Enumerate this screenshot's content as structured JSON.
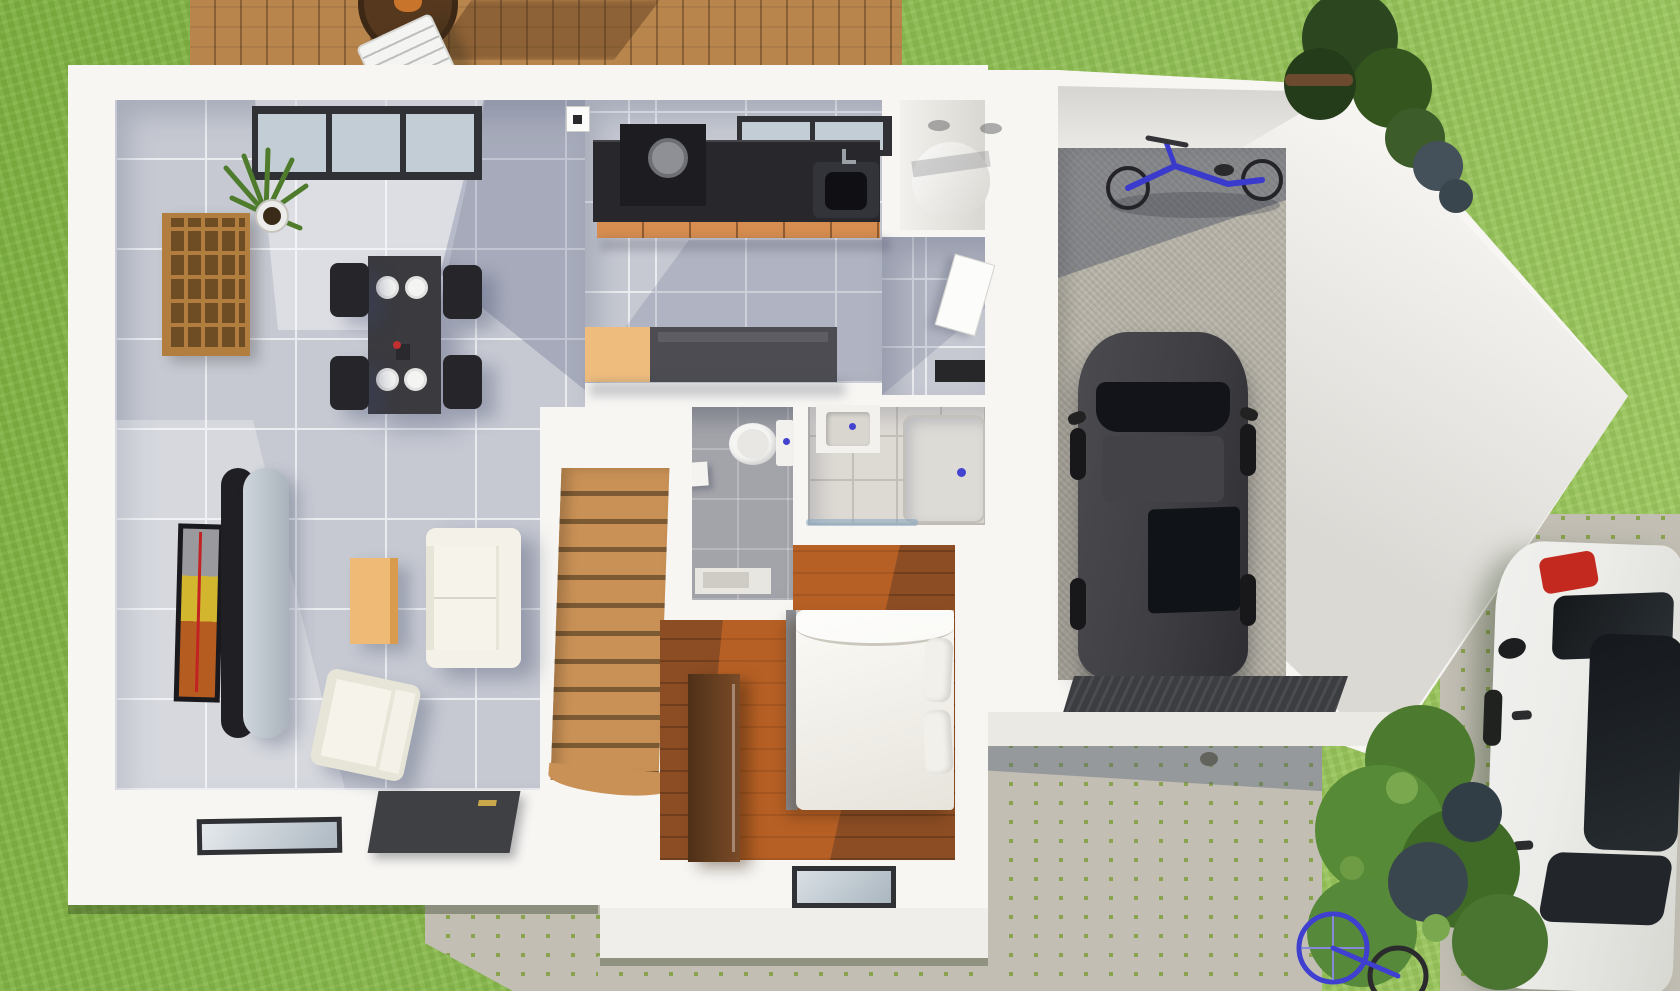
{
  "scene": {
    "description": "3D rendered top-down floor plan of a single-family house with attached garage, lawn, wooden deck, cobblestone driveway and two cars",
    "view": "top-down 3d architectural render",
    "visible_text": ""
  },
  "palette": {
    "grass-a": "#7fb141",
    "grass-b": "#8dbc51",
    "grass-c": "#a2cb63",
    "deck-wood": "#b8854d",
    "deck-gap": "#8a6136",
    "wall": "#f7f6f3",
    "wall-shade": "#dedcd7",
    "tile": "#c6c9d2",
    "grout": "#eaecf0",
    "wc-floor": "#a3a4aa",
    "bath-floor": "#ddd9d3",
    "bath-grout": "#c2beb8",
    "wood-floor": "#8c4d24",
    "wood-lit": "rgba(255,130,40,0.38)",
    "stair-wood": "#c99156",
    "stair-gap": "#7c5a33",
    "counter": "#27272c",
    "cabinet": "#d68d4f",
    "island": "#4c4c52",
    "island-tan": "#eebd7e",
    "table": "#3a3a3f",
    "chair": "#26262a",
    "plate": "#f4f4f3",
    "sofa": "#e7e5d8",
    "sofa-light": "#f4f2e8",
    "coffee": "#efba76",
    "tv-black": "#1a1a1e",
    "stand-gray": "#b9c0c9",
    "art-yellow": "#d2b62e",
    "art-orange": "#b55c20",
    "shelf": "#b27e40",
    "shelf-cell": "#6f4d24",
    "plant": "#4f7c2c",
    "pot": "#ececea",
    "fixture": "#f5f5f3",
    "blue": "#4343cf",
    "frame": "#2f3135",
    "glass": "#c2cdd6",
    "gravel": "#b7b3a8",
    "grate": "#3b3d40",
    "car-dark": "#3f3f43",
    "car-glass": "#121419",
    "car-white": "#ecece9",
    "tail-red": "#c3291f",
    "bike-blue": "#3a3acc",
    "cobble": "#c2beb4",
    "cobble-joint": "#8aa34f",
    "bush-a": "#4c7a2e",
    "bush-b": "#578a36",
    "bush-dark": "#3a464e",
    "tree": "#2c4720",
    "door-dark": "#3e4044",
    "handle-gold": "#c9a84c",
    "shadow": "rgba(70,80,115,0.25)"
  },
  "inventory": {
    "rooms": [
      "living-dining-room",
      "kitchen",
      "utility-closet",
      "hallway",
      "wc",
      "bathroom",
      "bedroom",
      "staircase",
      "garage"
    ],
    "outdoor": [
      "lawn",
      "wooden-deck",
      "cobblestone-driveway",
      "cobblestone-paths",
      "bushes",
      "tree"
    ],
    "objects": [
      "dining-table-with-plates",
      "four-black-chairs",
      "cube-shelf",
      "potted-plant",
      "tv-and-media-unit",
      "sofa",
      "armchair",
      "coffee-table",
      "kitchen-counter-with-sink",
      "kitchen-island",
      "water-heater-cylinder",
      "toilet",
      "vanity-sink",
      "shower",
      "double-bed",
      "wardrobe",
      "dark-suv-in-garage",
      "white-car-parked",
      "blue-bicycle-in-garage",
      "bicycle-by-bushes",
      "garage-floor-grate",
      "deck-table-and-chair"
    ]
  }
}
